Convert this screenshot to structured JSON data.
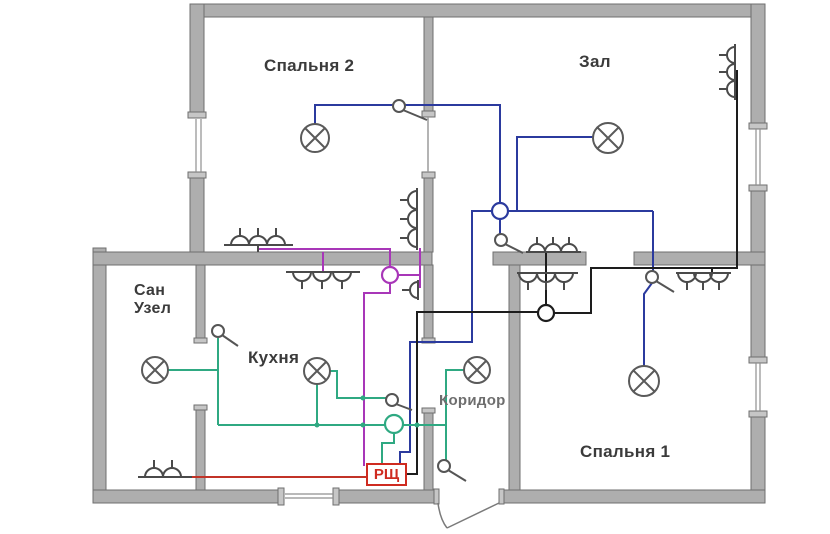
{
  "labels": {
    "bedroom2": "Спальня 2",
    "hall": "Зал",
    "bathroom": "Сан\nУзел",
    "kitchen": "Кухня",
    "corridor": "Коридор",
    "bedroom1": "Спальня 1",
    "panel": "РЩ"
  },
  "circuit_colors": {
    "lighting_main": "#2b3a9e",
    "outlets_kitchen": "#a836b8",
    "lighting_wet_rooms": "#2fa982",
    "outlets_rooms": "#1d1d1d",
    "outlet_bathroom": "#c23327",
    "panel_accent": "#cf2b20"
  },
  "counts": {
    "ceiling_lights": 6,
    "switches": 6,
    "junction_boxes": 4,
    "outlet_groups": 8,
    "distribution_boards": 1
  }
}
